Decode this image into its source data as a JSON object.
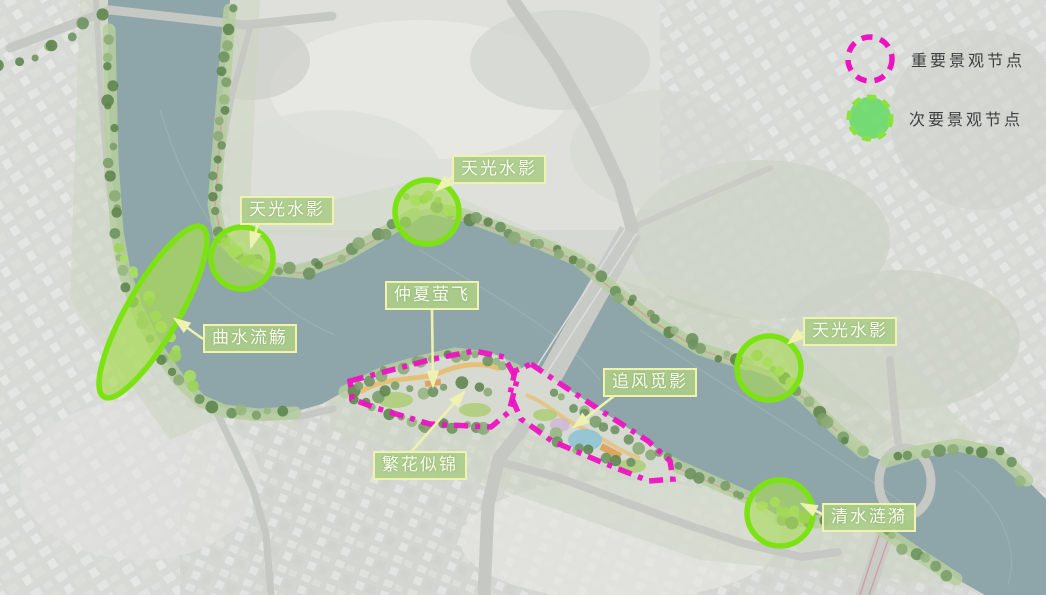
{
  "legend": {
    "items": [
      {
        "label": "重要景观节点",
        "style": "important"
      },
      {
        "label": "次要景观节点",
        "style": "secondary"
      }
    ]
  },
  "colors": {
    "important_stroke": "#ee13c2",
    "secondary_stroke": "#7de214",
    "secondary_fill": "#a9dc55",
    "label_background": "#adcd8a",
    "label_border": "#f0f3ae",
    "label_text": "#f7feee",
    "leader_line": "#eef1b0",
    "water": "#8ea6a9"
  },
  "nodes": {
    "important": [
      {
        "name": "仲夏萤飞·繁花似锦",
        "shape": "polygon",
        "points": "350,381 433,359 474,351 504,357 517,380 509,412 491,427 430,424 376,408 352,399"
      },
      {
        "name": "追风觅影",
        "shape": "polygon",
        "points": "531,364 562,385 603,412 648,441 670,461 673,479 649,481 601,462 552,441 521,419 510,394 515,371"
      }
    ],
    "secondary": [
      {
        "name": "天光水影",
        "shape": "circle",
        "cx": 242,
        "cy": 258,
        "r": 31
      },
      {
        "name": "天光水影",
        "shape": "circle",
        "cx": 427,
        "cy": 212,
        "r": 32
      },
      {
        "name": "天光水影",
        "shape": "circle",
        "cx": 769,
        "cy": 368,
        "r": 32
      },
      {
        "name": "清水涟漪",
        "shape": "circle",
        "cx": 780,
        "cy": 513,
        "r": 33
      },
      {
        "name": "曲水流觞",
        "shape": "ellipse",
        "cx": 153,
        "cy": 312,
        "rx": 26,
        "ry": 98,
        "rotate": 30
      }
    ]
  },
  "labels": [
    {
      "text": "天光水影",
      "x": 240,
      "y": 196,
      "leader": {
        "x1": 258,
        "y1": 224,
        "x2": 251,
        "y2": 247
      }
    },
    {
      "text": "天光水影",
      "x": 452,
      "y": 155,
      "leader": {
        "x1": 456,
        "y1": 174,
        "x2": 437,
        "y2": 190
      }
    },
    {
      "text": "天光水影",
      "x": 803,
      "y": 317,
      "leader": {
        "x1": 803,
        "y1": 332,
        "x2": 789,
        "y2": 343
      }
    },
    {
      "text": "曲水流觞",
      "x": 203,
      "y": 324,
      "leader": {
        "x1": 203,
        "y1": 339,
        "x2": 175,
        "y2": 319
      }
    },
    {
      "text": "仲夏萤飞",
      "x": 385,
      "y": 281,
      "leader": {
        "x1": 432,
        "y1": 309,
        "x2": 433,
        "y2": 386
      }
    },
    {
      "text": "繁花似锦",
      "x": 373,
      "y": 451,
      "leader": {
        "x1": 412,
        "y1": 451,
        "x2": 464,
        "y2": 392
      }
    },
    {
      "text": "追风觅影",
      "x": 603,
      "y": 368,
      "leader": {
        "x1": 614,
        "y1": 396,
        "x2": 574,
        "y2": 427
      }
    },
    {
      "text": "清水涟漪",
      "x": 822,
      "y": 503,
      "leader": {
        "x1": 822,
        "y1": 514,
        "x2": 802,
        "y2": 504
      }
    }
  ]
}
